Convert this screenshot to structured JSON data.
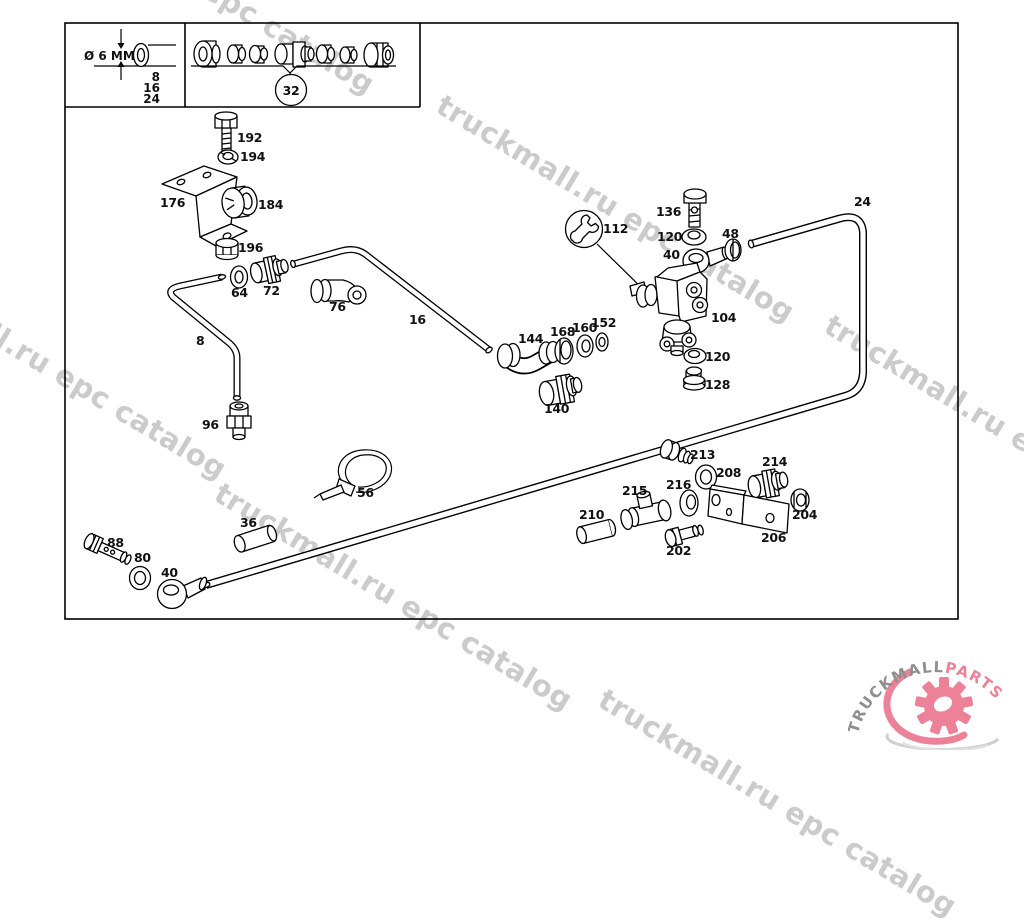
{
  "watermark": {
    "text": "truckmall.ru epc catalog",
    "color": "#cbcbcb"
  },
  "legend": {
    "diameter": "Ø 6 MM",
    "tube_sizes": [
      "8",
      "16",
      "24"
    ],
    "fitting_group_number": "32"
  },
  "part_labels": [
    "192",
    "194",
    "176",
    "184",
    "196",
    "64",
    "72",
    "76",
    "8",
    "16",
    "96",
    "144",
    "168",
    "160",
    "152",
    "140",
    "112",
    "136",
    "120",
    "40",
    "48",
    "104",
    "120",
    "128",
    "24",
    "56",
    "36",
    "88",
    "80",
    "40",
    "213",
    "208",
    "214",
    "216",
    "215",
    "210",
    "202",
    "204",
    "206"
  ],
  "logo": {
    "brand_gray": "TRUCKMALL",
    "brand_pink": "PARTS",
    "gray_color": "#8f8f8f",
    "pink_color": "#ec8197"
  }
}
